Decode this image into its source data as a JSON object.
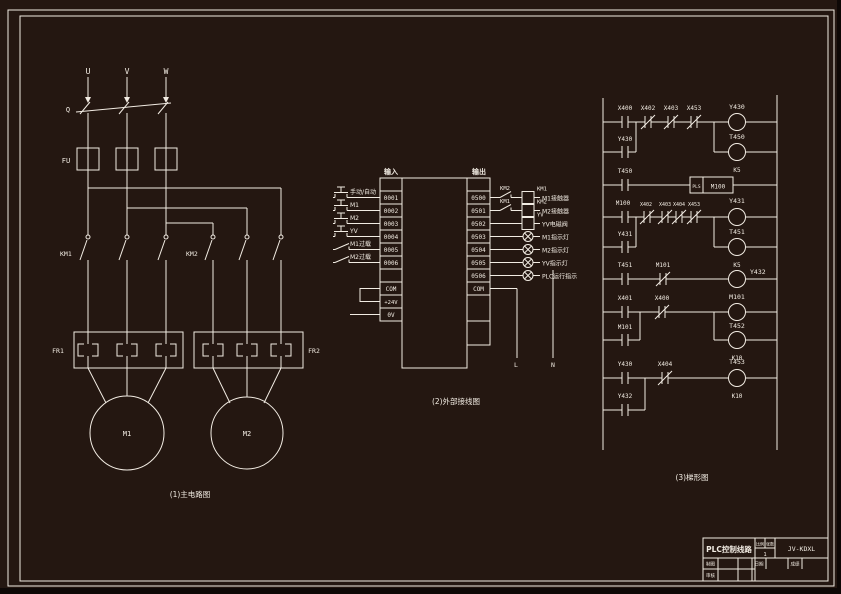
{
  "page": {
    "background": "#241711",
    "line_color": "#f2ece3"
  },
  "captions": {
    "main": "(1)主电路图",
    "wiring": "(2)外部接线图",
    "ladder": "(3)梯形图"
  },
  "main_circuit": {
    "phases": [
      "U",
      "V",
      "W"
    ],
    "switch": "Q",
    "fuse": "FU",
    "contactors": [
      "KM1",
      "KM2"
    ],
    "overload_relays": [
      "FR1",
      "FR2"
    ],
    "motors": [
      "M1",
      "M2"
    ]
  },
  "wiring": {
    "input_header": "输入",
    "output_header": "输出",
    "inputs": [
      {
        "addr": "0001",
        "device": "手动/自动"
      },
      {
        "addr": "0002",
        "device": "M1"
      },
      {
        "addr": "0003",
        "device": "M2"
      },
      {
        "addr": "0004",
        "device": "YV"
      },
      {
        "addr": "0005",
        "device": "M1过载"
      },
      {
        "addr": "0006",
        "device": "M2过载"
      }
    ],
    "terminals": {
      "com_in": "COM",
      "plus24": "+24V",
      "zero": "0V",
      "com_out": "COM",
      "live": "L",
      "neutral": "N"
    },
    "outputs": [
      {
        "addr": "0500",
        "contact": "KM2",
        "coil": "KM1",
        "desc": "M1接触器"
      },
      {
        "addr": "0501",
        "contact": "KM1",
        "coil": "KM2",
        "desc": "M2接触器"
      },
      {
        "addr": "0502",
        "coil": "YV",
        "desc": "YV电磁阀"
      },
      {
        "addr": "0503",
        "desc": "M1指示灯"
      },
      {
        "addr": "0504",
        "desc": "M2指示灯"
      },
      {
        "addr": "0505",
        "desc": "YV指示灯"
      },
      {
        "addr": "0506",
        "desc": "PLC运行指示"
      }
    ]
  },
  "ladder": {
    "r1": {
      "c1": "X400",
      "c2": "X402",
      "c3": "X403",
      "c4": "X453",
      "coil": "Y430",
      "seal": "Y430",
      "timer": "T450",
      "k": "K5"
    },
    "r2": {
      "c1": "T450",
      "fn": "PLS",
      "operand": "M100"
    },
    "r3": {
      "c1": "M100",
      "c2": "X402",
      "c3": "X403",
      "c4": "X404",
      "c5": "X453",
      "coil": "Y431",
      "seal": "Y431",
      "timer": "T451",
      "k": "K5"
    },
    "r4": {
      "c1": "T451",
      "c2": "M101",
      "coil": "Y432"
    },
    "r5": {
      "c1": "X401",
      "c2": "X400",
      "coil": "M101",
      "seal": "M101",
      "timer": "T452",
      "k": "K10"
    },
    "r6": {
      "c1": "Y430",
      "c2": "X404",
      "coil": "T453",
      "k": "K10",
      "seal": "Y432"
    }
  },
  "title_block": {
    "project": "PLC控制线路",
    "scale_label": "比例",
    "sheet_label": "张数",
    "sheet_value": "1",
    "drawing_no": "JV-KDXL",
    "drafter_label": "制图",
    "checker_label": "审核",
    "date_label": "日期",
    "grade_label": "成绩"
  }
}
